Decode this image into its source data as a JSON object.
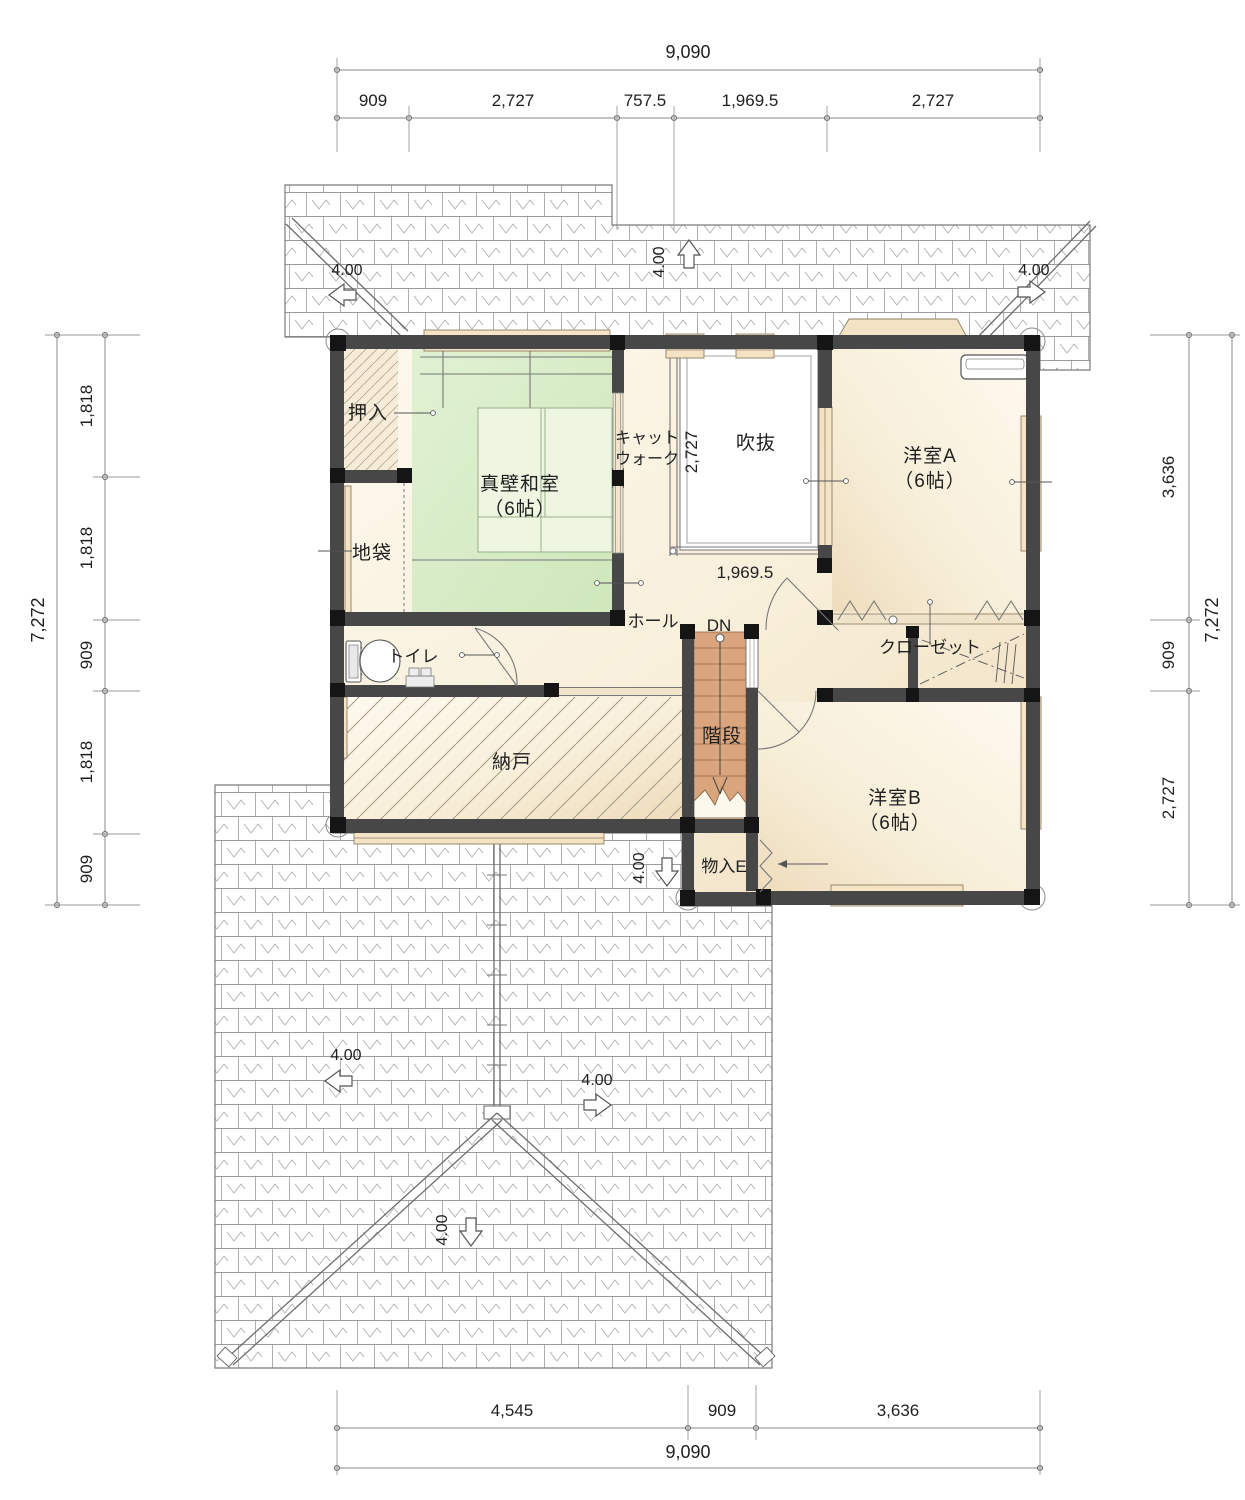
{
  "drawing": {
    "type": "floor-plan",
    "floor": "2F"
  },
  "dims": {
    "top": {
      "overall": "9,090",
      "seg": [
        "909",
        "2,727",
        "757.5",
        "1,969.5",
        "2,727"
      ]
    },
    "bottom": {
      "overall": "9,090",
      "seg": [
        "4,545",
        "909",
        "3,636"
      ]
    },
    "left": {
      "overall": "7,272",
      "seg": [
        "1,818",
        "1,818",
        "909",
        "1,818",
        "909"
      ]
    },
    "right": {
      "overall": "7,272",
      "seg": [
        "3,636",
        "909",
        "2,727"
      ]
    },
    "interior": {
      "void_height": "2,727",
      "void_width": "1,969.5"
    }
  },
  "rooms": {
    "oshiire": "押入",
    "washitsu": "真壁和室",
    "washitsu_size": "（6帖）",
    "jibukuro": "地袋",
    "catwalk1": "キャット",
    "catwalk2": "ウォーク",
    "fukinuke": "吹抜",
    "yoshitsuA": "洋室A",
    "yoshitsuA_size": "（6帖）",
    "toilet": "トイレ",
    "hall": "ホール",
    "dn": "DN",
    "kaidan": "階段",
    "nando": "納戸",
    "closet": "クローゼット",
    "yoshitsuB": "洋室B",
    "yoshitsuB_size": "（6帖）",
    "monoE": "物入E"
  },
  "roof": {
    "pitch": "4.00"
  },
  "colors": {
    "wall": "#474747",
    "corner_block": "#151515",
    "tatami": "#d9ecca",
    "stair_wood": "#daa47c",
    "window_sill": "#f4e3c5",
    "room_cream": "#f8efda",
    "roof_line": "#9b9b9b"
  }
}
